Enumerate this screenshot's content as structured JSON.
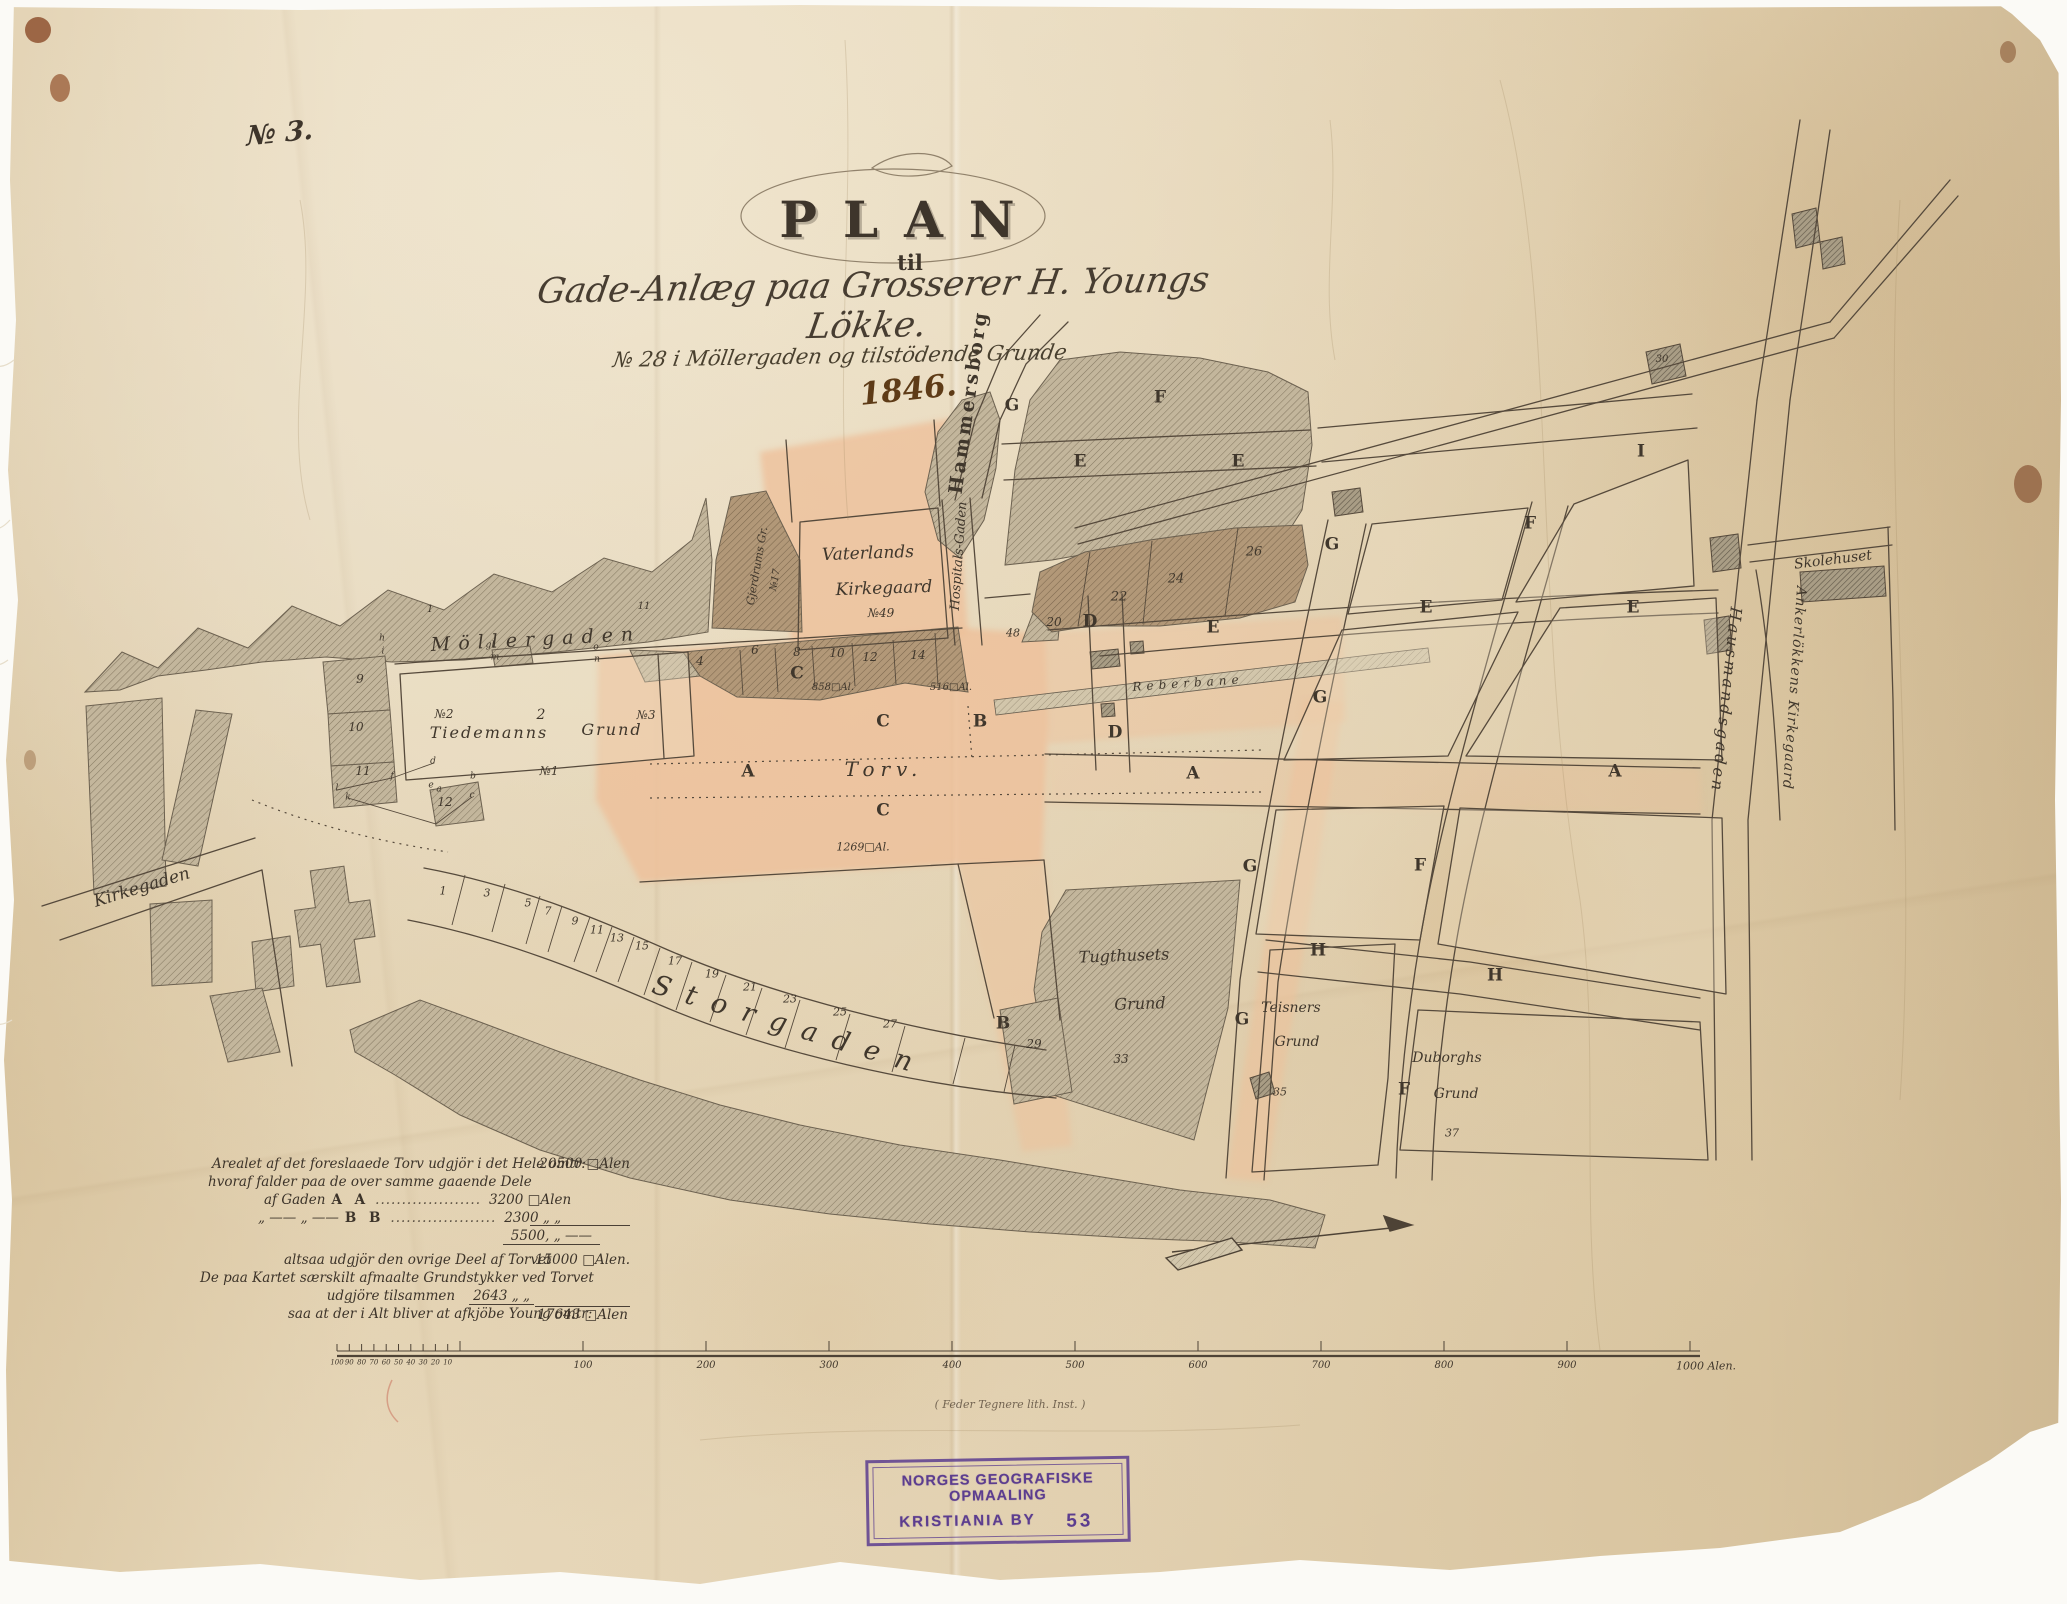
{
  "document": {
    "sheet_no": "№ 3.",
    "title": "PLAN",
    "title_prefix": "til",
    "subtitle_script": "Gade-Anlæg paa Grosserer H. Youngs Lökke.",
    "subtitle_line2": "№ 28 i Möllergaden og tilstödende Grunde",
    "year_annotation": "1846.",
    "lithographer_note": "( Feder Tegnere lith. Inst. )"
  },
  "stamp": {
    "line1": "NORGES GEOGRAFISKE OPMAALING",
    "line2": "KRISTIANIA BY",
    "number": "53",
    "ink_color": "#5c3d8f"
  },
  "area_table": {
    "rows": [
      {
        "text": "Arealet af det foreslaaede Torv udgjör i det Hele omtr:",
        "value": "20500 □Alen"
      },
      {
        "text": "hvoraf falder paa de over samme gaaende Dele"
      },
      {
        "pre": "af Gaden",
        "key": "A A",
        "leader": "....................",
        "value": "3200 □Alen"
      },
      {
        "pre": "„ —— „ ——",
        "key": "B B",
        "leader": "....................",
        "value": "2300 „ „"
      },
      {
        "value": "5500, „ ——"
      },
      {
        "text": "altsaa udgjör den ovrige Deel af Torvet",
        "value": "15000 □Alen."
      },
      {
        "text": "De paa Kartet særskilt afmaalte Grundstykker ved Torvet"
      },
      {
        "text": "udgjöre tilsammen",
        "value": "2643 „ „"
      },
      {
        "text": "saa at der i Alt bliver at afkjöbe Young omtr:",
        "value": "17643 □Alen"
      }
    ]
  },
  "scale_bar": {
    "minor_labels": [
      "100",
      "90",
      "80",
      "70",
      "60",
      "50",
      "40",
      "30",
      "20",
      "10"
    ],
    "major_labels": [
      "100",
      "200",
      "300",
      "400",
      "500",
      "600",
      "700",
      "800",
      "900"
    ],
    "end_label": "1000 Alen.",
    "unit": "Alen"
  },
  "map": {
    "ink_color": "#564a3c",
    "paper_color": "#e6d6b8",
    "wash_color": "#edc19b",
    "labels": [
      {
        "t": "Möllergaden",
        "x": 536,
        "y": 640,
        "c": "street",
        "r": -3,
        "s": 19,
        "ls": 8
      },
      {
        "t": "Storgaden",
        "x": 790,
        "y": 1026,
        "c": "street",
        "r": 17,
        "s": 27,
        "ls": 16
      },
      {
        "t": "Kirkegaden",
        "x": 142,
        "y": 888,
        "c": "scr",
        "r": -17,
        "s": 17
      },
      {
        "t": "Hammersborg",
        "x": 969,
        "y": 402,
        "c": "blk",
        "r": -82,
        "s": 19,
        "ls": 3
      },
      {
        "t": "Hospitals-Gaden",
        "x": 959,
        "y": 556,
        "c": "scr",
        "r": -86,
        "s": 13
      },
      {
        "t": "Hausmandsgaden",
        "x": 1726,
        "y": 700,
        "c": "scr",
        "r": 96,
        "s": 16,
        "ls": 3
      },
      {
        "t": "Ankerlökkens Kirkegaard",
        "x": 1794,
        "y": 688,
        "c": "scr",
        "r": 94,
        "s": 14,
        "ls": 1
      },
      {
        "t": "Skolehuset",
        "x": 1833,
        "y": 560,
        "c": "scr",
        "r": -7,
        "s": 14
      },
      {
        "t": "Vaterlands",
        "x": 868,
        "y": 554,
        "c": "scr",
        "r": -2,
        "s": 17
      },
      {
        "t": "Kirkegaard",
        "x": 884,
        "y": 589,
        "c": "scr",
        "r": -2,
        "s": 17
      },
      {
        "t": "№49",
        "x": 881,
        "y": 613,
        "c": "scr",
        "r": 0,
        "s": 12
      },
      {
        "t": "Gjerdrums Gr.",
        "x": 757,
        "y": 566,
        "c": "scr",
        "r": -80,
        "s": 11
      },
      {
        "t": "№17",
        "x": 776,
        "y": 580,
        "c": "scr",
        "r": -80,
        "s": 10
      },
      {
        "t": "№2",
        "x": 444,
        "y": 714,
        "c": "scr",
        "r": 0,
        "s": 12
      },
      {
        "t": "2",
        "x": 541,
        "y": 715,
        "c": "num",
        "r": 0,
        "s": 14
      },
      {
        "t": "№3",
        "x": 646,
        "y": 715,
        "c": "scr",
        "r": 0,
        "s": 12
      },
      {
        "t": "Tiedemanns",
        "x": 489,
        "y": 733,
        "c": "scr",
        "r": 0,
        "s": 16,
        "ls": 2
      },
      {
        "t": "Grund",
        "x": 612,
        "y": 730,
        "c": "scr",
        "r": 0,
        "s": 16,
        "ls": 2
      },
      {
        "t": "№1",
        "x": 549,
        "y": 771,
        "c": "scr",
        "r": 0,
        "s": 12
      },
      {
        "t": "Torv.",
        "x": 884,
        "y": 769,
        "c": "scr",
        "r": 0,
        "s": 20,
        "ls": 6
      },
      {
        "t": "Reberbane",
        "x": 1188,
        "y": 683,
        "c": "scr",
        "r": -4,
        "s": 12,
        "ls": 5
      },
      {
        "t": "Tugthusets",
        "x": 1124,
        "y": 956,
        "c": "scr",
        "r": -2,
        "s": 16
      },
      {
        "t": "Grund",
        "x": 1140,
        "y": 1004,
        "c": "scr",
        "r": -2,
        "s": 16
      },
      {
        "t": "33",
        "x": 1121,
        "y": 1059,
        "c": "num",
        "r": 0,
        "s": 12
      },
      {
        "t": "Teisners",
        "x": 1291,
        "y": 1008,
        "c": "scr",
        "r": 0,
        "s": 14
      },
      {
        "t": "Grund",
        "x": 1297,
        "y": 1042,
        "c": "scr",
        "r": 0,
        "s": 14
      },
      {
        "t": "35",
        "x": 1280,
        "y": 1092,
        "c": "num",
        "r": 0,
        "s": 11
      },
      {
        "t": "Duborghs",
        "x": 1447,
        "y": 1058,
        "c": "scr",
        "r": 0,
        "s": 14
      },
      {
        "t": "Grund",
        "x": 1456,
        "y": 1094,
        "c": "scr",
        "r": 0,
        "s": 14
      },
      {
        "t": "37",
        "x": 1452,
        "y": 1133,
        "c": "num",
        "r": 0,
        "s": 11
      },
      {
        "t": "C",
        "x": 797,
        "y": 674,
        "c": "blk",
        "r": 0,
        "s": 17
      },
      {
        "t": "C",
        "x": 883,
        "y": 722,
        "c": "blk",
        "r": 0,
        "s": 17
      },
      {
        "t": "C",
        "x": 883,
        "y": 811,
        "c": "blk",
        "r": 0,
        "s": 17
      },
      {
        "t": "B",
        "x": 980,
        "y": 722,
        "c": "blk",
        "r": 0,
        "s": 17
      },
      {
        "t": "B",
        "x": 1003,
        "y": 1024,
        "c": "blk",
        "r": 0,
        "s": 17
      },
      {
        "t": "A",
        "x": 748,
        "y": 772,
        "c": "blk",
        "r": 0,
        "s": 17
      },
      {
        "t": "A",
        "x": 1193,
        "y": 774,
        "c": "blk",
        "r": 0,
        "s": 17
      },
      {
        "t": "A",
        "x": 1615,
        "y": 772,
        "c": "blk",
        "r": 0,
        "s": 17
      },
      {
        "t": "D",
        "x": 1090,
        "y": 622,
        "c": "blk",
        "r": 0,
        "s": 17
      },
      {
        "t": "D",
        "x": 1115,
        "y": 733,
        "c": "blk",
        "r": 0,
        "s": 17
      },
      {
        "t": "E",
        "x": 1213,
        "y": 628,
        "c": "blk",
        "r": 0,
        "s": 17
      },
      {
        "t": "E",
        "x": 1426,
        "y": 608,
        "c": "blk",
        "r": 0,
        "s": 17
      },
      {
        "t": "E",
        "x": 1633,
        "y": 608,
        "c": "blk",
        "r": 0,
        "s": 17
      },
      {
        "t": "E",
        "x": 1080,
        "y": 462,
        "c": "blk",
        "r": 0,
        "s": 17
      },
      {
        "t": "E",
        "x": 1238,
        "y": 462,
        "c": "blk",
        "r": 0,
        "s": 17
      },
      {
        "t": "F",
        "x": 1530,
        "y": 524,
        "c": "blk",
        "r": 0,
        "s": 17
      },
      {
        "t": "F",
        "x": 1420,
        "y": 866,
        "c": "blk",
        "r": 0,
        "s": 17
      },
      {
        "t": "F",
        "x": 1404,
        "y": 1090,
        "c": "blk",
        "r": 0,
        "s": 17
      },
      {
        "t": "F",
        "x": 1160,
        "y": 398,
        "c": "blk",
        "r": 0,
        "s": 17
      },
      {
        "t": "G",
        "x": 1012,
        "y": 406,
        "c": "blk",
        "r": 0,
        "s": 17
      },
      {
        "t": "G",
        "x": 1332,
        "y": 545,
        "c": "blk",
        "r": 0,
        "s": 17
      },
      {
        "t": "G",
        "x": 1320,
        "y": 698,
        "c": "blk",
        "r": 0,
        "s": 17
      },
      {
        "t": "G",
        "x": 1250,
        "y": 867,
        "c": "blk",
        "r": 0,
        "s": 17
      },
      {
        "t": "G",
        "x": 1242,
        "y": 1020,
        "c": "blk",
        "r": 0,
        "s": 17
      },
      {
        "t": "H",
        "x": 1318,
        "y": 951,
        "c": "blk",
        "r": 0,
        "s": 17
      },
      {
        "t": "H",
        "x": 1495,
        "y": 976,
        "c": "blk",
        "r": 0,
        "s": 17
      },
      {
        "t": "I",
        "x": 1641,
        "y": 452,
        "c": "blk",
        "r": 0,
        "s": 17
      },
      {
        "t": "4",
        "x": 700,
        "y": 661,
        "c": "num",
        "r": 0,
        "s": 12
      },
      {
        "t": "6",
        "x": 755,
        "y": 650,
        "c": "num",
        "r": 0,
        "s": 12
      },
      {
        "t": "8",
        "x": 797,
        "y": 652,
        "c": "num",
        "r": 0,
        "s": 12
      },
      {
        "t": "10",
        "x": 837,
        "y": 653,
        "c": "num",
        "r": 0,
        "s": 12
      },
      {
        "t": "12",
        "x": 870,
        "y": 657,
        "c": "num",
        "r": 0,
        "s": 12
      },
      {
        "t": "14",
        "x": 918,
        "y": 655,
        "c": "num",
        "r": 0,
        "s": 12
      },
      {
        "t": "20",
        "x": 1054,
        "y": 622,
        "c": "num",
        "r": 0,
        "s": 12
      },
      {
        "t": "22",
        "x": 1119,
        "y": 597,
        "c": "num",
        "r": 0,
        "s": 13
      },
      {
        "t": "24",
        "x": 1176,
        "y": 579,
        "c": "num",
        "r": 0,
        "s": 13
      },
      {
        "t": "26",
        "x": 1254,
        "y": 552,
        "c": "num",
        "r": 0,
        "s": 13
      },
      {
        "t": "48",
        "x": 1013,
        "y": 633,
        "c": "num",
        "r": 0,
        "s": 11
      },
      {
        "t": "30",
        "x": 1662,
        "y": 360,
        "c": "num",
        "r": 0,
        "s": 10
      },
      {
        "t": "29",
        "x": 1034,
        "y": 1044,
        "c": "num",
        "r": 0,
        "s": 12
      },
      {
        "t": "9",
        "x": 360,
        "y": 679,
        "c": "num",
        "r": 0,
        "s": 12
      },
      {
        "t": "10",
        "x": 356,
        "y": 727,
        "c": "num",
        "r": 0,
        "s": 12
      },
      {
        "t": "11",
        "x": 363,
        "y": 771,
        "c": "num",
        "r": 0,
        "s": 12
      },
      {
        "t": "12",
        "x": 445,
        "y": 802,
        "c": "num",
        "r": 0,
        "s": 12
      },
      {
        "t": "1",
        "x": 430,
        "y": 610,
        "c": "num",
        "r": 0,
        "s": 10
      },
      {
        "t": "11",
        "x": 644,
        "y": 607,
        "c": "num",
        "r": 0,
        "s": 10
      },
      {
        "t": "1",
        "x": 443,
        "y": 891,
        "c": "num",
        "r": 0,
        "s": 11
      },
      {
        "t": "3",
        "x": 487,
        "y": 893,
        "c": "num",
        "r": 0,
        "s": 11
      },
      {
        "t": "5",
        "x": 528,
        "y": 903,
        "c": "num",
        "r": 0,
        "s": 11
      },
      {
        "t": "7",
        "x": 548,
        "y": 911,
        "c": "num",
        "r": 0,
        "s": 11
      },
      {
        "t": "9",
        "x": 575,
        "y": 921,
        "c": "num",
        "r": 0,
        "s": 11
      },
      {
        "t": "11",
        "x": 597,
        "y": 930,
        "c": "num",
        "r": 0,
        "s": 11
      },
      {
        "t": "13",
        "x": 617,
        "y": 938,
        "c": "num",
        "r": 0,
        "s": 11
      },
      {
        "t": "15",
        "x": 642,
        "y": 946,
        "c": "num",
        "r": 0,
        "s": 11
      },
      {
        "t": "17",
        "x": 675,
        "y": 961,
        "c": "num",
        "r": 0,
        "s": 11
      },
      {
        "t": "19",
        "x": 712,
        "y": 974,
        "c": "num",
        "r": 0,
        "s": 11
      },
      {
        "t": "21",
        "x": 750,
        "y": 987,
        "c": "num",
        "r": 0,
        "s": 11
      },
      {
        "t": "23",
        "x": 790,
        "y": 999,
        "c": "num",
        "r": 0,
        "s": 11
      },
      {
        "t": "25",
        "x": 840,
        "y": 1012,
        "c": "num",
        "r": 0,
        "s": 11
      },
      {
        "t": "27",
        "x": 890,
        "y": 1024,
        "c": "num",
        "r": 0,
        "s": 11
      },
      {
        "t": "858□Al.",
        "x": 833,
        "y": 688,
        "c": "num",
        "r": 0,
        "s": 10
      },
      {
        "t": "516□Al.",
        "x": 951,
        "y": 688,
        "c": "num",
        "r": 0,
        "s": 10
      },
      {
        "t": "1269□Al.",
        "x": 863,
        "y": 847,
        "c": "num",
        "r": 0,
        "s": 11
      },
      {
        "t": "h",
        "x": 382,
        "y": 639,
        "c": "num",
        "r": 0,
        "s": 9
      },
      {
        "t": "i",
        "x": 383,
        "y": 652,
        "c": "num",
        "r": 0,
        "s": 9
      },
      {
        "t": "gl",
        "x": 490,
        "y": 646,
        "c": "num",
        "r": 0,
        "s": 9
      },
      {
        "t": "m",
        "x": 495,
        "y": 658,
        "c": "num",
        "r": 0,
        "s": 9
      },
      {
        "t": "o",
        "x": 596,
        "y": 648,
        "c": "num",
        "r": 0,
        "s": 9
      },
      {
        "t": "n",
        "x": 597,
        "y": 660,
        "c": "num",
        "r": 0,
        "s": 9
      },
      {
        "t": "d",
        "x": 433,
        "y": 762,
        "c": "num",
        "r": 0,
        "s": 9
      },
      {
        "t": "f",
        "x": 392,
        "y": 777,
        "c": "num",
        "r": 0,
        "s": 9
      },
      {
        "t": "l",
        "x": 337,
        "y": 789,
        "c": "num",
        "r": 0,
        "s": 9
      },
      {
        "t": "k",
        "x": 348,
        "y": 798,
        "c": "num",
        "r": 0,
        "s": 9
      },
      {
        "t": "e",
        "x": 431,
        "y": 786,
        "c": "num",
        "r": 0,
        "s": 9
      },
      {
        "t": "a",
        "x": 439,
        "y": 790,
        "c": "num",
        "r": 0,
        "s": 9
      },
      {
        "t": "b",
        "x": 473,
        "y": 777,
        "c": "num",
        "r": 0,
        "s": 9
      },
      {
        "t": "c",
        "x": 472,
        "y": 796,
        "c": "num",
        "r": 0,
        "s": 9
      }
    ]
  }
}
